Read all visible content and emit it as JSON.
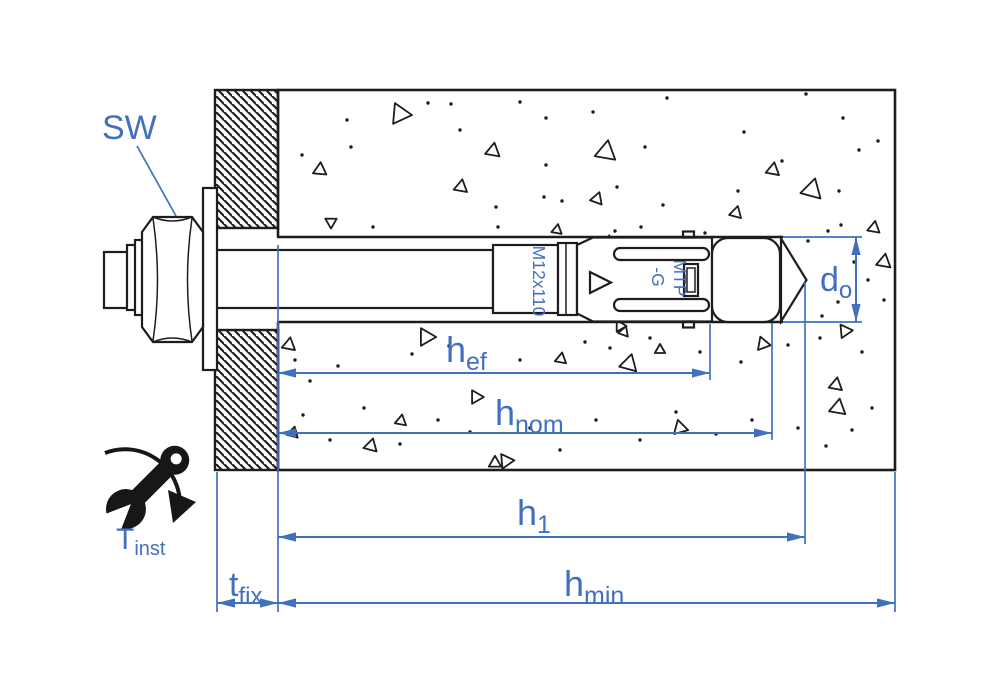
{
  "diagram": {
    "type": "technical-installation-drawing",
    "subject": "Torque-controlled expansion anchor installed through a fixture into concrete",
    "colors": {
      "dimension_blue": "#4170be",
      "line_black": "#1d1d1f",
      "background": "#ffffff"
    },
    "labels": {
      "wrench_size": "SW",
      "anchor_marking_size": "M12x110",
      "anchor_marking_model_line1": "MTP",
      "anchor_marking_model_line2": "-G",
      "torque": {
        "main": "T",
        "sub": "inst"
      }
    },
    "dimensions": {
      "hole_diameter": {
        "main": "d",
        "sub": "o"
      },
      "effective_embedment_depth": {
        "main": "h",
        "sub": "ef"
      },
      "nominal_embedment_depth": {
        "main": "h",
        "sub": "nom"
      },
      "drill_hole_depth": {
        "main": "h",
        "sub": "1"
      },
      "min_member_thickness": {
        "main": "h",
        "sub": "min"
      },
      "fixture_thickness": {
        "main": "t",
        "sub": "fix"
      }
    },
    "texture": {
      "triangles": [
        [
          400,
          114,
          20,
          215
        ],
        [
          320,
          170,
          13,
          245
        ],
        [
          493,
          151,
          14,
          250
        ],
        [
          461,
          187,
          13,
          10
        ],
        [
          606,
          152,
          20,
          10
        ],
        [
          597,
          199,
          12,
          20
        ],
        [
          608,
          243,
          13,
          250
        ],
        [
          557,
          230,
          10,
          250
        ],
        [
          773,
          170,
          13,
          250
        ],
        [
          812,
          190,
          20,
          15
        ],
        [
          736,
          213,
          12,
          15
        ],
        [
          874,
          228,
          12,
          10
        ],
        [
          884,
          262,
          14,
          250
        ],
        [
          331,
          222,
          11,
          300
        ],
        [
          289,
          345,
          13,
          250
        ],
        [
          426,
          337,
          17,
          210
        ],
        [
          561,
          359,
          11,
          250
        ],
        [
          629,
          364,
          17,
          15
        ],
        [
          624,
          332,
          10,
          20
        ],
        [
          660,
          350,
          10,
          0
        ],
        [
          763,
          344,
          13,
          340
        ],
        [
          836,
          385,
          13,
          250
        ],
        [
          838,
          408,
          16,
          10
        ],
        [
          845,
          331,
          13,
          205
        ],
        [
          476,
          397,
          13,
          210
        ],
        [
          401,
          421,
          11,
          10
        ],
        [
          371,
          446,
          13,
          15
        ],
        [
          506,
          461,
          14,
          205
        ],
        [
          680,
          428,
          14,
          345
        ],
        [
          495,
          463,
          12,
          0
        ],
        [
          620,
          326,
          11,
          210
        ],
        [
          293,
          433,
          11,
          15
        ]
      ],
      "dots": [
        [
          347,
          120
        ],
        [
          451,
          104
        ],
        [
          520,
          102
        ],
        [
          546,
          118
        ],
        [
          593,
          112
        ],
        [
          667,
          98
        ],
        [
          806,
          94
        ],
        [
          843,
          118
        ],
        [
          744,
          132
        ],
        [
          859,
          150
        ],
        [
          302,
          155
        ],
        [
          351,
          147
        ],
        [
          546,
          165
        ],
        [
          645,
          147
        ],
        [
          617,
          187
        ],
        [
          544,
          197
        ],
        [
          562,
          201
        ],
        [
          663,
          205
        ],
        [
          738,
          191
        ],
        [
          839,
          191
        ],
        [
          782,
          161
        ],
        [
          373,
          227
        ],
        [
          300,
          239
        ],
        [
          496,
          207
        ],
        [
          498,
          227
        ],
        [
          510,
          241
        ],
        [
          542,
          241
        ],
        [
          615,
          231
        ],
        [
          641,
          227
        ],
        [
          705,
          233
        ],
        [
          732,
          253
        ],
        [
          768,
          245
        ],
        [
          808,
          241
        ],
        [
          841,
          225
        ],
        [
          878,
          141
        ],
        [
          460,
          130
        ],
        [
          428,
          103
        ],
        [
          828,
          231
        ],
        [
          854,
          262
        ],
        [
          868,
          280
        ],
        [
          884,
          300
        ],
        [
          838,
          302
        ],
        [
          822,
          316
        ],
        [
          295,
          360
        ],
        [
          310,
          381
        ],
        [
          338,
          366
        ],
        [
          412,
          354
        ],
        [
          449,
          346
        ],
        [
          520,
          360
        ],
        [
          585,
          342
        ],
        [
          610,
          348
        ],
        [
          650,
          338
        ],
        [
          700,
          352
        ],
        [
          741,
          362
        ],
        [
          788,
          345
        ],
        [
          820,
          338
        ],
        [
          862,
          352
        ],
        [
          303,
          415
        ],
        [
          330,
          440
        ],
        [
          364,
          408
        ],
        [
          400,
          444
        ],
        [
          438,
          420
        ],
        [
          470,
          432
        ],
        [
          530,
          428
        ],
        [
          560,
          450
        ],
        [
          596,
          420
        ],
        [
          640,
          440
        ],
        [
          676,
          412
        ],
        [
          716,
          434
        ],
        [
          752,
          420
        ],
        [
          798,
          428
        ],
        [
          826,
          446
        ],
        [
          852,
          430
        ],
        [
          872,
          408
        ]
      ]
    }
  }
}
